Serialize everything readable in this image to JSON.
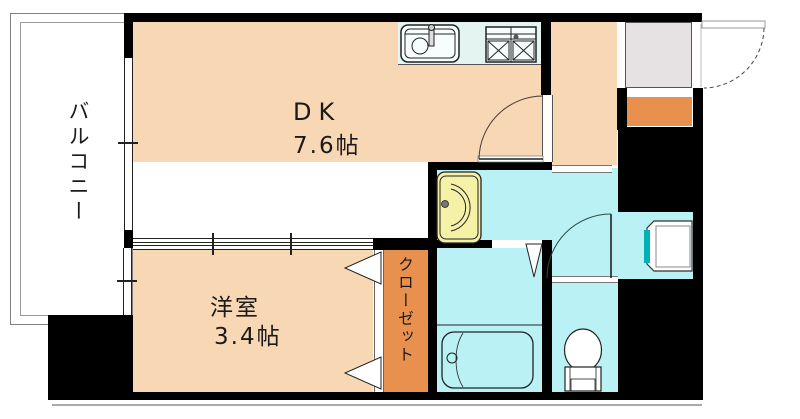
{
  "floorplan": {
    "type": "japanese-apartment-floor-plan",
    "rooms": {
      "dk": {
        "label": "DK",
        "size": "7.6帖"
      },
      "western_room": {
        "label": "洋室",
        "size": "3.4帖"
      },
      "closet": {
        "label": "クローゼット"
      },
      "balcony": {
        "label": "バルコニー"
      }
    },
    "fixtures": [
      "kitchen-sink",
      "gas-stove",
      "wash-basin",
      "bathtub",
      "toilet",
      "washing-machine-pan",
      "entrance-door",
      "dk-hall-door",
      "toilet-door",
      "bathroom-folding-door",
      "closet-folding-doors",
      "sliding-partition",
      "balcony-windows",
      "shoe-cabinet",
      "entrance-step"
    ],
    "colors": {
      "room_floor": "#f8d8b4",
      "wet_area": "#b9f1f4",
      "kitchen_counter": "#e4f4f1",
      "closet_orange": "#e8914f",
      "entrance_gray": "#e6e2e4",
      "basin_yellow": "#f5f1a6",
      "teal_accent": "#00b2b5",
      "wall": "#000000"
    }
  }
}
